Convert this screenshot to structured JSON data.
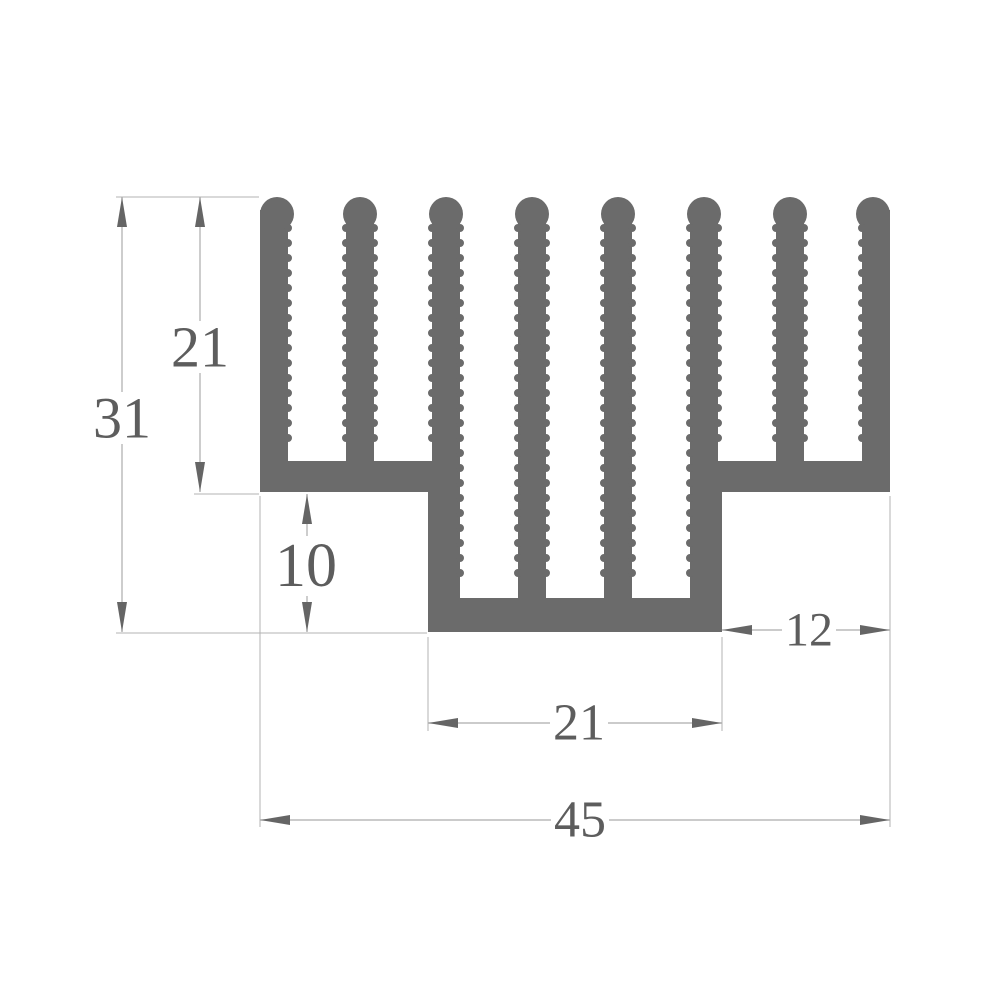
{
  "drawing": {
    "kind": "heatsink-extrusion-cross-section",
    "dimensions": {
      "total_height": "31",
      "wing_height": "21",
      "step_height": "10",
      "right_wing_width": "12",
      "center_width": "21",
      "total_width": "45"
    },
    "colors": {
      "profile_fill": "#6b6b6b",
      "dimension_line": "#acacac",
      "arrow": "#656565",
      "text": "#5d5d5d",
      "background": "#ffffff"
    }
  }
}
